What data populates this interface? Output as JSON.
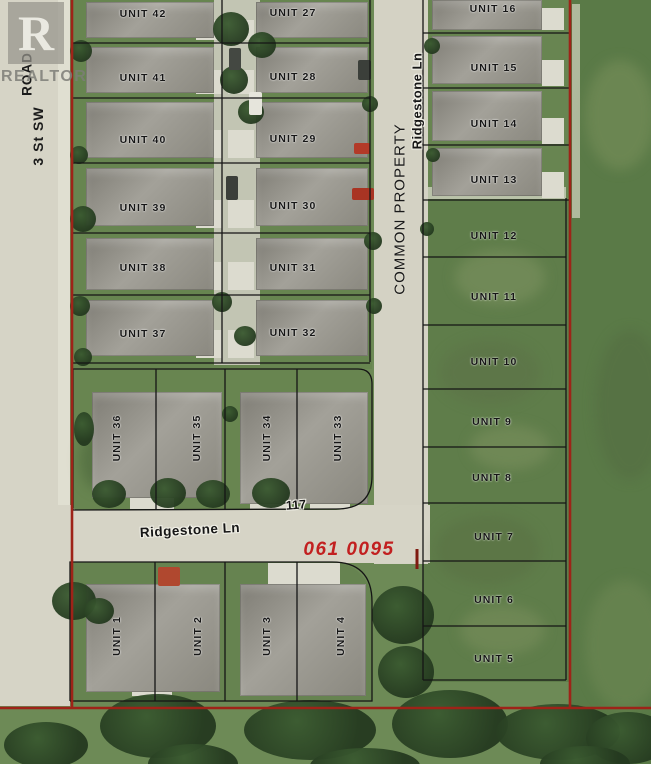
{
  "watermark": {
    "logo_letter": "R",
    "name": "REALTOR"
  },
  "streets": {
    "road_vertical": "ROAD",
    "street_3_sw": "3 St SW",
    "ridgestone_vertical": "Ridgestone  Ln",
    "common_property": "COMMON PROPERTY",
    "ridgestone_horizontal": "Ridgestone  Ln"
  },
  "annotations": {
    "house_number": "117",
    "parcel_number": "061 0095"
  },
  "colors": {
    "boundary_red": "#9e2318",
    "parcel_text_red": "#c22020",
    "line_black": "#151515",
    "label_black": "#161616",
    "pavement": "#d5d3c5",
    "grass": "#6d8a56",
    "field_green": "#5a7a47",
    "roof_gray": "#908e86",
    "tree_dark": "#2c4527"
  },
  "units": [
    {
      "label": "UNIT 42",
      "x": 143,
      "y": 14,
      "rot": 0
    },
    {
      "label": "UNIT 41",
      "x": 143,
      "y": 78,
      "rot": 0
    },
    {
      "label": "UNIT 40",
      "x": 143,
      "y": 140,
      "rot": 0
    },
    {
      "label": "UNIT 39",
      "x": 143,
      "y": 208,
      "rot": 0
    },
    {
      "label": "UNIT 38",
      "x": 143,
      "y": 268,
      "rot": 0
    },
    {
      "label": "UNIT 37",
      "x": 143,
      "y": 334,
      "rot": 0
    },
    {
      "label": "UNIT 27",
      "x": 293,
      "y": 13,
      "rot": 0
    },
    {
      "label": "UNIT 28",
      "x": 293,
      "y": 77,
      "rot": 0
    },
    {
      "label": "UNIT 29",
      "x": 293,
      "y": 139,
      "rot": 0
    },
    {
      "label": "UNIT 30",
      "x": 293,
      "y": 206,
      "rot": 0
    },
    {
      "label": "UNIT 31",
      "x": 293,
      "y": 268,
      "rot": 0
    },
    {
      "label": "UNIT 32",
      "x": 293,
      "y": 333,
      "rot": 0
    },
    {
      "label": "UNIT 16",
      "x": 493,
      "y": 9,
      "rot": 0
    },
    {
      "label": "UNIT 15",
      "x": 494,
      "y": 68,
      "rot": 0
    },
    {
      "label": "UNIT 14",
      "x": 494,
      "y": 124,
      "rot": 0
    },
    {
      "label": "UNIT 13",
      "x": 494,
      "y": 180,
      "rot": 0
    },
    {
      "label": "UNIT 12",
      "x": 494,
      "y": 236,
      "rot": 0
    },
    {
      "label": "UNIT 11",
      "x": 494,
      "y": 297,
      "rot": 0
    },
    {
      "label": "UNIT 10",
      "x": 494,
      "y": 362,
      "rot": 0
    },
    {
      "label": "UNIT 9",
      "x": 492,
      "y": 422,
      "rot": 0
    },
    {
      "label": "UNIT 8",
      "x": 492,
      "y": 478,
      "rot": 0
    },
    {
      "label": "UNIT 7",
      "x": 494,
      "y": 537,
      "rot": 0
    },
    {
      "label": "UNIT 6",
      "x": 494,
      "y": 600,
      "rot": 0
    },
    {
      "label": "UNIT 5",
      "x": 494,
      "y": 659,
      "rot": 0
    },
    {
      "label": "UNIT 36",
      "x": 117,
      "y": 438,
      "rot": -90
    },
    {
      "label": "UNIT 35",
      "x": 197,
      "y": 438,
      "rot": -90
    },
    {
      "label": "UNIT 34",
      "x": 267,
      "y": 438,
      "rot": -90
    },
    {
      "label": "UNIT 33",
      "x": 338,
      "y": 438,
      "rot": -90
    },
    {
      "label": "UNIT 1",
      "x": 117,
      "y": 636,
      "rot": -90
    },
    {
      "label": "UNIT 2",
      "x": 198,
      "y": 636,
      "rot": -90
    },
    {
      "label": "UNIT 3",
      "x": 267,
      "y": 636,
      "rot": -90
    },
    {
      "label": "UNIT 4",
      "x": 341,
      "y": 636,
      "rot": -90
    }
  ]
}
